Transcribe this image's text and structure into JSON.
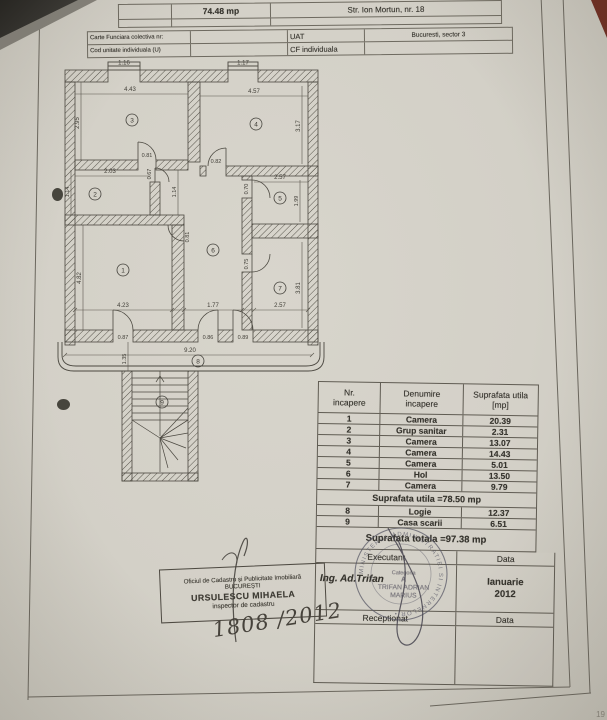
{
  "colors": {
    "paper": "#d3d0c7",
    "ink": "#35332d",
    "table_line": "#5f5b52",
    "stamp_ink": "#5a5a66"
  },
  "header_table": {
    "area_value": "74.48 mp",
    "address": "Str. Ion Mortun, nr. 18",
    "carte_funciara_label": "Carte Funciara colectiva nr:",
    "uat_label": "UAT",
    "uat_value": "Bucuresti, sector 3",
    "cod_unitate_label": "Cod unitate individuala (U)",
    "cf_label": "CF individuala"
  },
  "plan": {
    "rooms": [
      "1",
      "2",
      "3",
      "4",
      "5",
      "6",
      "7",
      "8",
      "9"
    ],
    "dims": {
      "win_left": "1.16",
      "win_right": "1.17",
      "room3_w": "4.43",
      "room3_h": "2.95",
      "room4_w": "4.57",
      "room4_h": "3.17",
      "door3": "0.81",
      "door4": "0.82",
      "room2_w": "2.03",
      "room2_h": "1.14",
      "door2": "0.67",
      "corridor_w": "1.14",
      "room5_w": "2.57",
      "room5_h": "1.99",
      "door5": "0.70",
      "hall_door": "0.81",
      "door7": "0.75",
      "room1_h": "4.82",
      "room1_w": "4.23",
      "hall_w": "1.77",
      "room7_w": "2.57",
      "room7_h": "3.81",
      "door_b1": "0.87",
      "door_b2": "0.86",
      "door_b3": "0.89",
      "loggia_w": "9.20",
      "loggia_h": "1.35"
    }
  },
  "room_table": {
    "headers": {
      "nr_1": "Nr.",
      "nr_2": "incapere",
      "name_1": "Denumire",
      "name_2": "incapere",
      "area_1": "Suprafata utila",
      "area_2": "[mp]"
    },
    "rows": [
      {
        "nr": "1",
        "name": "Camera",
        "area": "20.39"
      },
      {
        "nr": "2",
        "name": "Grup sanitar",
        "area": "2.31"
      },
      {
        "nr": "3",
        "name": "Camera",
        "area": "13.07"
      },
      {
        "nr": "4",
        "name": "Camera",
        "area": "14.43"
      },
      {
        "nr": "5",
        "name": "Camera",
        "area": "5.01"
      },
      {
        "nr": "6",
        "name": "Hol",
        "area": "13.50"
      },
      {
        "nr": "7",
        "name": "Camera",
        "area": "9.79"
      }
    ],
    "subtotal": "Suprafata utila =78.50 mp",
    "extra_rows": [
      {
        "nr": "8",
        "name": "Logie",
        "area": "12.37"
      },
      {
        "nr": "9",
        "name": "Casa scarii",
        "area": "6.51"
      }
    ],
    "total": "Suprafata totala =97.38 mp",
    "executant_label": "Executant",
    "data_label": "Data",
    "executant_name": "Ing. Ad.Trifan",
    "date_month": "Ianuarie",
    "date_year": "2012",
    "receptionat_label": "Receptionat",
    "data_label_2": "Data"
  },
  "stamps": {
    "office_line1": "Oficiul de Cadastru și Publicitate Imobiliară",
    "office_line2": "BUCUREȘTI",
    "office_line3": "URSULESCU MIHAELA",
    "office_line4": "inspector de cadastru",
    "handwritten_ref": "1808 /2012",
    "round_stamp_ring": "MINISTERUL ADMINISTRATIEI SI INTERNELOR • ",
    "exec_stamp_l1": "Categoria",
    "exec_stamp_l2": "A",
    "exec_stamp_l3": "TRIFAN ADRIAN",
    "exec_stamp_l4": "MARIUS"
  },
  "page_mark": "19"
}
